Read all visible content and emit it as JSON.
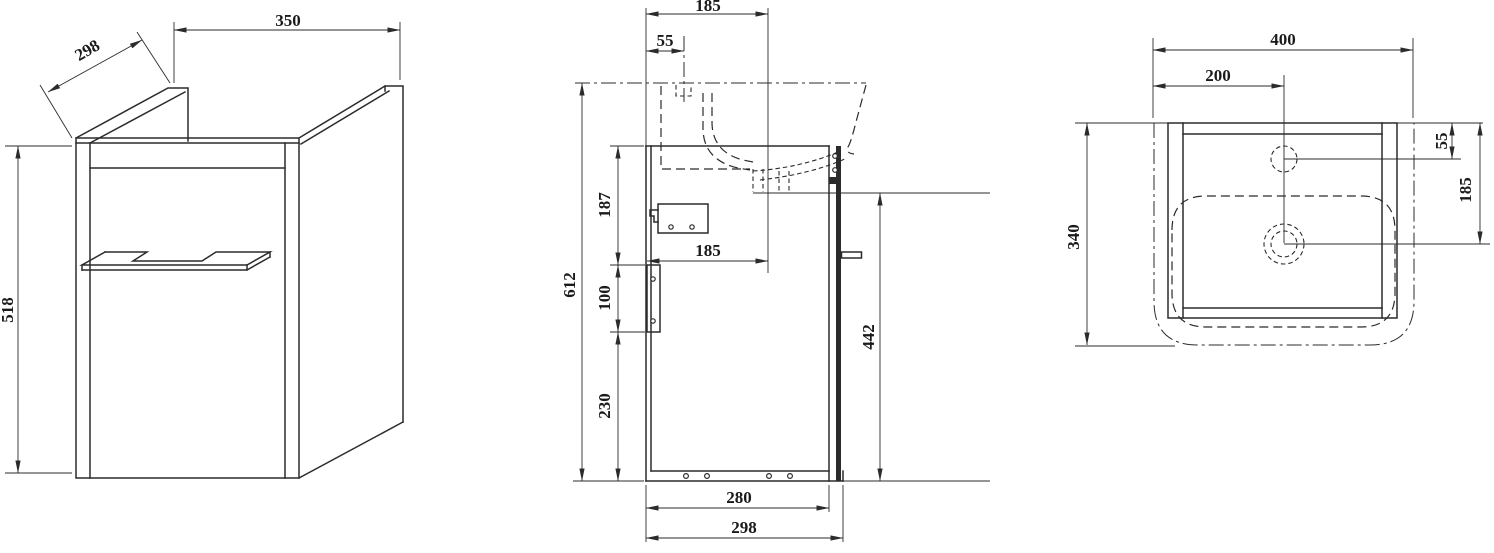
{
  "title": "Wall-hung washbasin vanity cabinet — dimensioned technical drawing",
  "units": "mm",
  "colors": {
    "line": "#2b2b2b",
    "background": "#ffffff"
  },
  "views": {
    "isometric": {
      "name": "isometric view",
      "width": "350",
      "depth": "298",
      "height": "518"
    },
    "side": {
      "name": "side section view",
      "depth_to_drain_top": "185",
      "faucet_offset": "55",
      "overall_height": "612",
      "section_top": "187",
      "section_rail": "100",
      "section_bottom": "230",
      "depth_to_drain_mid": "185",
      "drain_height": "442",
      "inner_depth": "280",
      "overall_depth": "298"
    },
    "plan": {
      "name": "top plan view",
      "basin_width": "400",
      "center_offset": "200",
      "faucet_from_back": "55",
      "drain_from_back": "185",
      "basin_depth": "340"
    }
  }
}
